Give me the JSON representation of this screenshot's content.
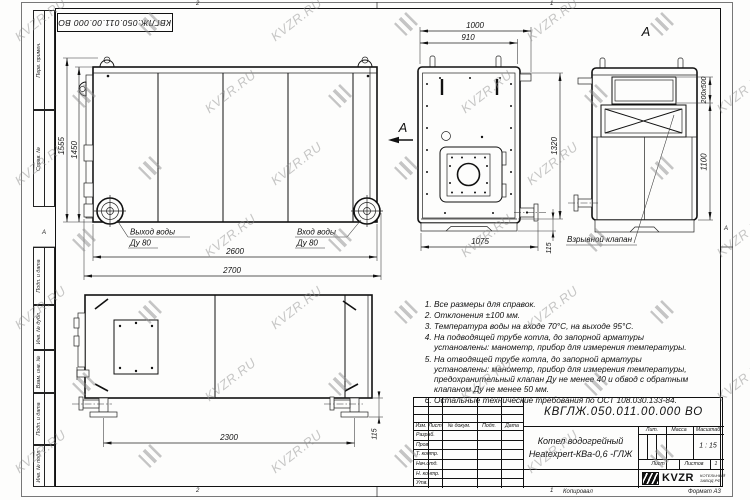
{
  "watermark": {
    "text": "KVZR.RU",
    "color": "#909090"
  },
  "frame": {
    "top_stamp": "КВГЛЖ.050.011.00.000 ВО",
    "left_fields": [
      "Перв. примен.",
      "Справ. №",
      "Подп. и дата",
      "Инв. № дубл.",
      "Взам. инв. №",
      "Подп. и дата",
      "Инв. № подл."
    ],
    "zone_top_left": "2",
    "zone_top_right": "1",
    "zone_bottom_left": "2",
    "zone_bottom_right": "1",
    "zone_side_left": "А",
    "zone_side_right": "А",
    "copied_label": "Копировал",
    "format_label": "Формат А3"
  },
  "views": {
    "front": {
      "dim_height_total": "1555",
      "dim_height_body": "1450",
      "dim_width_body": "2600",
      "dim_width_total": "2700",
      "outlet_label": "Выход воды",
      "outlet_dn": "Ду 80",
      "inlet_label": "Вход воды",
      "inlet_dn": "Ду 80",
      "view_arrow_label": "А"
    },
    "end": {
      "dim_width_total": "1000",
      "dim_width_body": "910",
      "dim_height": "1320",
      "dim_skid": "115",
      "dim_base": "1075"
    },
    "rear": {
      "view_title": "А",
      "dim_window": "200x500",
      "dim_height": "1100",
      "valve_label": "Взрывной клапан"
    },
    "side": {
      "dim_feet_span": "2300",
      "dim_foot_height": "115"
    }
  },
  "notes": [
    "Все размеры для справок.",
    "Отклонения ±100 мм.",
    "Температура воды на входе 70°С, на выходе 95°С.",
    "На подводящей трубе котла, до запорной арматуры установлены: манометр, прибор для измерения температуры.",
    "На отводящей трубе котла, до запорной арматуры установлены: манометр, прибор для измерения температуры, предохранительный клапан Ду не менее 40 и обвод с обратным клапаном Ду не менее 50 мм.",
    "Остальные технические требования по ОСТ 108.030.133-84."
  ],
  "title_block": {
    "doc_number": "КВГЛЖ.050.011.00.000 ВО",
    "product_line1": "Котел водогрейный",
    "product_line2": "Heatexpert-КВа-0,6 -ГЛЖ",
    "header_cols": [
      "Изм.",
      "Лист",
      "№ докум.",
      "Подп.",
      "Дата"
    ],
    "rows": [
      "Разраб.",
      "Пров.",
      "Т. контр.",
      "Нач.отд.",
      "Н. контр.",
      "Утв."
    ],
    "lit_label": "Лит.",
    "mass_label": "Масса",
    "scale_label": "Масштаб",
    "scale_value": "1 : 15",
    "sheet_label": "Лист",
    "sheets_label": "Листов",
    "sheets_value": "1",
    "logo_word": "KVZR",
    "logo_sub1": "КОТЕЛЬНЫЙ",
    "logo_sub2": "ЗАВОД РФ"
  }
}
